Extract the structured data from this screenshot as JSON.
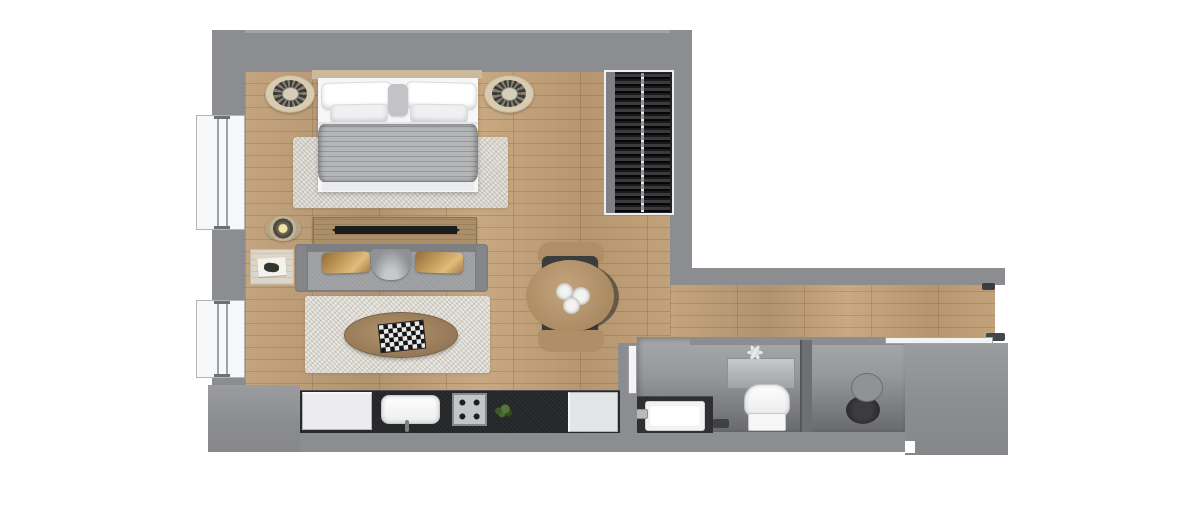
{
  "scene": {
    "kind": "apartment-floor-plan",
    "view": "top-down-3d-render",
    "background": "#ffffff",
    "canvas": {
      "width": 1200,
      "height": 507
    }
  },
  "palette": {
    "wall": "#8c8d90",
    "wall_edge": "#a2a3a5",
    "wood": "#bda077",
    "rug": "#eae7e1",
    "blanket": "#b5b6b8",
    "counter": "#242527",
    "tv": "#1b1c1d",
    "wardrobe": "#232325",
    "chair_dark": "#3b3c3e",
    "pillow_gold": "#c79e5e",
    "bath_floor": "#97989b",
    "fixture_white": "#f4f4f5",
    "plant_green": "#4a6a32"
  },
  "structure": {
    "walls": [
      "top",
      "left",
      "bottom",
      "right-upper",
      "corridor-top",
      "kitchen-bathroom-divider",
      "bathroom-top",
      "right-block",
      "bottom-left-block"
    ],
    "windows": [
      {
        "wall": "left",
        "position": "upper"
      },
      {
        "wall": "left",
        "position": "lower"
      }
    ],
    "openings": [
      {
        "name": "entry-opening",
        "location": "corridor-east-end"
      },
      {
        "name": "bathroom-doorway",
        "location": "bathroom-north-west"
      }
    ]
  },
  "rooms": [
    {
      "name": "bedroom-living-area",
      "floor": "wood-plank",
      "items": [
        "double-bed",
        "headboard",
        "bed-pillows",
        "blanket",
        "bedside-table-left",
        "bedside-table-right",
        "bedroom-rug",
        "wardrobe",
        "tv-console",
        "tv",
        "decor-spotlight",
        "side-table",
        "sofa",
        "sofa-pillow-left",
        "sofa-pillow-right",
        "throw-blanket",
        "living-rug",
        "coffee-table",
        "chessboard",
        "dining-table",
        "dining-chair-north",
        "dining-chair-south",
        "plates"
      ]
    },
    {
      "name": "kitchen",
      "floor": "wood-plank",
      "items": [
        "kitchen-counter",
        "refrigerator-cabinet",
        "kitchen-sink",
        "kitchen-faucet",
        "cooktop",
        "plant",
        "cabinet"
      ]
    },
    {
      "name": "corridor",
      "floor": "wood-plank",
      "items": []
    },
    {
      "name": "bathroom",
      "floor": "gray-tile",
      "items": [
        "bathroom-door",
        "vanity-counter",
        "bathroom-sink",
        "bathroom-faucet",
        "mirror-shelf",
        "exhaust-fan",
        "toilet",
        "floor-drain",
        "shower-partition",
        "shower-stool",
        "shower-glass-strip"
      ]
    }
  ],
  "counts": {
    "rooms": 4,
    "windows": 2,
    "dining_chairs": 2,
    "plates": 3,
    "cooktop_burners": 4,
    "sofa_pillows": 2,
    "bed_pillows": 4
  }
}
